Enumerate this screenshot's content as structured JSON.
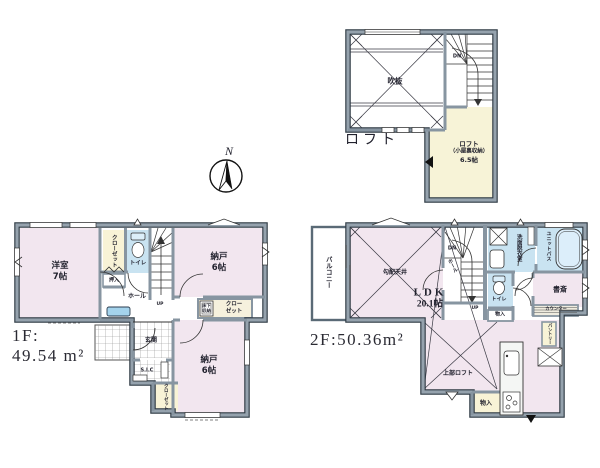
{
  "document_type": "floor-plan",
  "palette": {
    "wall_gray": "#95a2ad",
    "wall_edge": "#2f3a44",
    "room_pink": "#f2e6ef",
    "closet_yellow": "#f8f3d6",
    "wet_area_blue": "#c9e3f1",
    "loft_yellow": "#f7f3d7",
    "background": "#ffffff"
  },
  "compass": {
    "label": "N"
  },
  "loft": {
    "title": "ロフト",
    "void_label": "吹抜",
    "stairs_down": "DN",
    "room_label_line1": "ロフト",
    "room_label_line2": "（小屋裏収納）",
    "room_label_line3": "6.5帖"
  },
  "floor1": {
    "area_line1": "1F:",
    "area_line2": "49.54 m²",
    "rooms": {
      "yoshitsu_name": "洋室",
      "yoshitsu_size": "7帖",
      "closet_top": "クローゼット",
      "toilet": "トイレ",
      "nando_upper_name": "納戸",
      "nando_upper_size": "6帖",
      "oshiire": "押入",
      "hall": "ホール",
      "stairs_up": "UP",
      "underfloor_line1": "床下",
      "underfloor_line2": "収納",
      "closet_mid_line1": "クロー",
      "closet_mid_line2": "ゼット",
      "genkan": "玄関",
      "sic": "S.I.C",
      "nando_lower_name": "納戸",
      "nando_lower_size": "6帖",
      "closet_bottom": "クローゼット"
    }
  },
  "floor2": {
    "area_label": "2F:50.36m²",
    "rooms": {
      "balcony": "バルコニー",
      "sloped_ceiling": "勾配天井",
      "ldk_name": "LDK",
      "ldk_size": "20.1帖",
      "stairs_down": "DN",
      "hall": "ホール",
      "stairs_up": "UP",
      "washroom": "洗面脱衣室",
      "unit_bath": "ユニットバス",
      "toilet": "トイレ",
      "storage_upper": "物入",
      "study": "書斎",
      "counter": "カウンター",
      "pantry": "パントリー",
      "upper_loft": "上部ロフト",
      "storage_lower": "物入"
    }
  }
}
